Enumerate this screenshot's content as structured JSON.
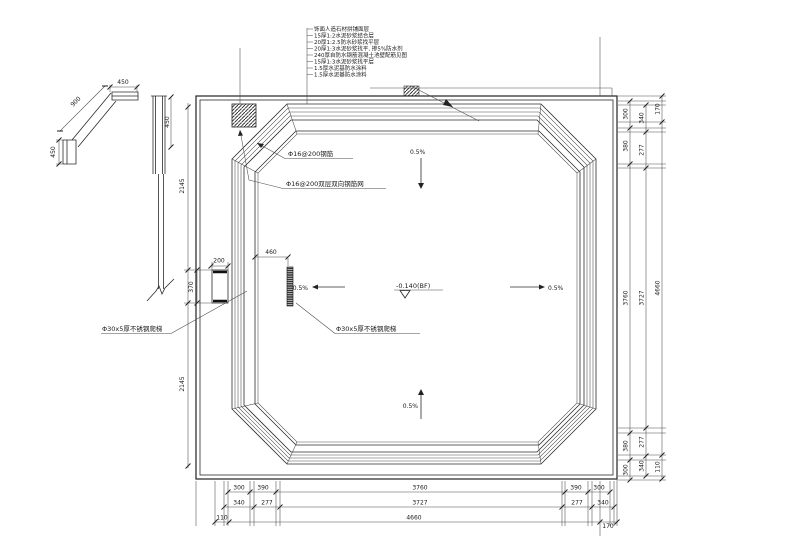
{
  "drawing": {
    "wall_layers": [
      "饰面人造石材拼铺面层",
      "15厚1:2水泥砂浆结合层",
      "20厚1:2.5防水砂浆找平层",
      "20厚1:3水泥砂浆找平, 掺5%防水剂",
      "240厚自防水钢筋混凝土池壁配筋见图",
      "15厚1:3水泥砂浆找平层",
      "1.5厚水泥基防水涂料",
      "1.5厚水泥基防水涂料"
    ],
    "callouts": {
      "rebar_top": "Φ16@200钢筋",
      "rebar_mesh": "Φ16@200双层双向钢筋网",
      "ladder_left": "Φ30x5厚不锈钢爬梯",
      "ladder_center": "Φ30x5厚不锈钢爬梯",
      "elevation": "-0.140(BF)"
    },
    "slopes": {
      "top": "0.5%",
      "bottom": "0.5%",
      "left": "0.5%",
      "right": "0.5%"
    },
    "detail": {
      "coping_width": "450",
      "diagonal": "900",
      "coping_height": "450",
      "section_height": "450"
    },
    "left_chain": {
      "upper": "2145",
      "ladder": "370",
      "lower": "2145"
    },
    "ladder_dims": {
      "width": "200",
      "offset": "460"
    },
    "bottom": {
      "row1": [
        "300",
        "390",
        "3760",
        "390",
        "300"
      ],
      "row2": [
        "340",
        "277",
        "3727",
        "277",
        "340"
      ],
      "row3": [
        "110",
        "4660",
        "170"
      ]
    },
    "right": {
      "col1": [
        "300",
        "380",
        "3760",
        "380",
        "300"
      ],
      "col2": [
        "340",
        "277",
        "3727",
        "277",
        "340"
      ],
      "col3": [
        "170",
        "4660",
        "110"
      ]
    }
  }
}
